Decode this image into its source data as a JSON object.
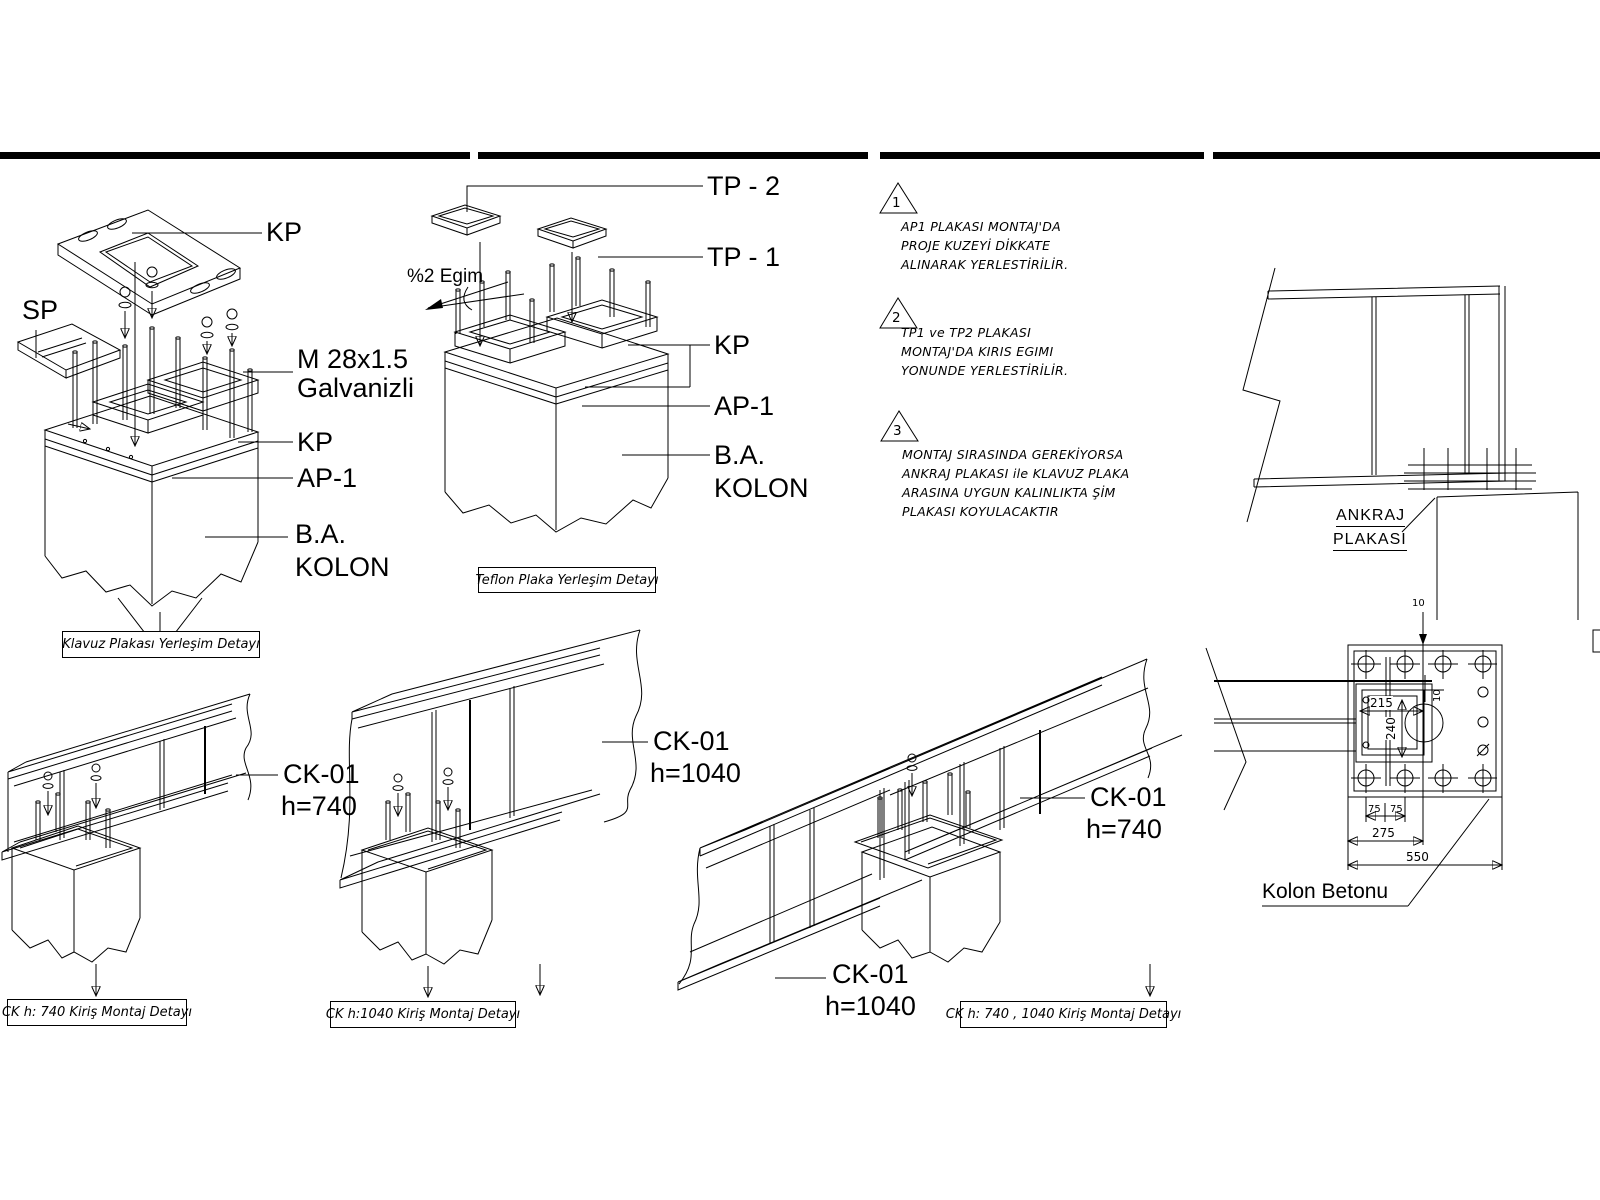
{
  "klavuz": {
    "kp_top": "KP",
    "sp": "SP",
    "bolt_line1": "M 28x1.5",
    "bolt_line2": "Galvanizli",
    "kp": "KP",
    "ap1": "AP-1",
    "ba": "B.A.",
    "kolon": "KOLON",
    "caption": "Klavuz Plakası Yerleşim Detayı"
  },
  "teflon": {
    "tp2": "TP - 2",
    "tp1": "TP - 1",
    "egim": "%2 Egim",
    "kp": "KP",
    "ap1": "AP-1",
    "ba": "B.A.",
    "kolon": "KOLON",
    "caption": "Teflon Plaka Yerleşim Detayı"
  },
  "notes": [
    {
      "num": "1",
      "lines": [
        "AP1 PLAKASI MONTAJ'DA",
        "PROJE KUZEYİ DİKKATE",
        "ALINARAK YERLESTİRİLİR."
      ]
    },
    {
      "num": "2",
      "lines": [
        "TP1 ve TP2 PLAKASI",
        "MONTAJ'DA KIRIS EGIMI",
        "YONUNDE YERLESTİRİLİR."
      ]
    },
    {
      "num": "3",
      "lines": [
        "MONTAJ SIRASINDA GEREKİYORSA",
        "ANKRAJ PLAKASI ile KLAVUZ PLAKA",
        "ARASINA UYGUN KALINLIKTA ŞİM",
        "PLAKASI KOYULACAKTIR"
      ]
    }
  ],
  "elevation": {
    "ankraj_line1": "ANKRAJ",
    "ankraj_line2": "PLAKASI"
  },
  "plan": {
    "d10_top": "10",
    "d10_side": "10",
    "d215": "215",
    "d240": "240",
    "d75_left": "75",
    "d75_right": "75",
    "d275": "275",
    "d550": "550",
    "kolon_betonu": "Kolon Betonu"
  },
  "beams": {
    "b740": {
      "mark": "CK-01",
      "h": "h=740",
      "caption": "CK h: 740 Kiriş Montaj Detayı"
    },
    "b1040": {
      "mark": "CK-01",
      "h": "h=1040",
      "caption": "CK h:1040 Kiriş Montaj Detayı"
    },
    "combo": {
      "mark_740": "CK-01",
      "h_740": "h=740",
      "mark_1040": "CK-01",
      "h_1040": "h=1040",
      "caption": "CK h: 740 , 1040 Kiriş Montaj Detayı"
    }
  }
}
